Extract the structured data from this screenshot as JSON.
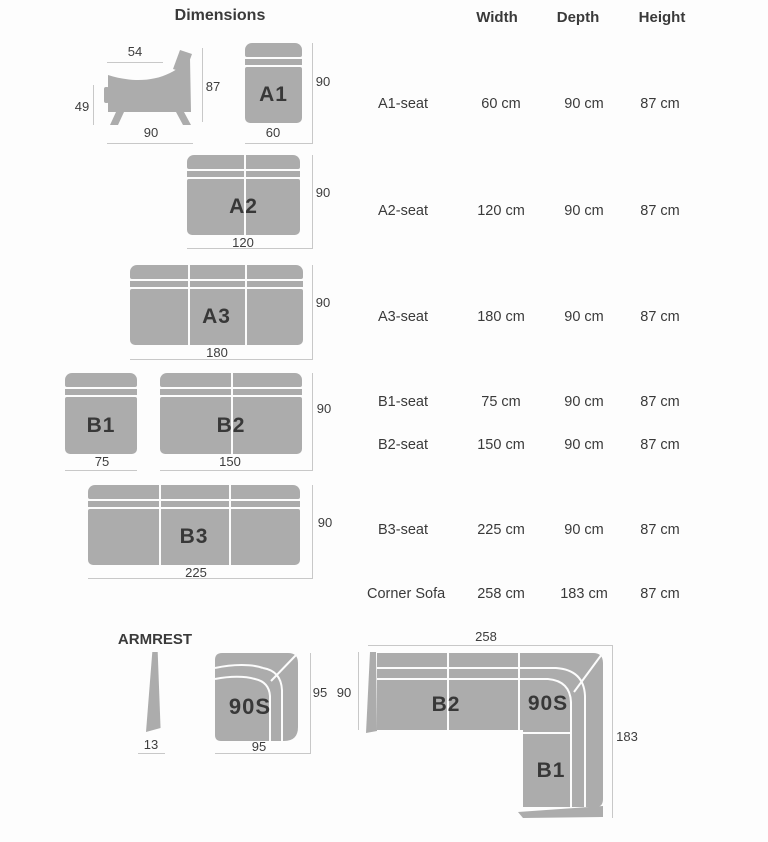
{
  "heading": "Dimensions",
  "table": {
    "headers": {
      "width": "Width",
      "depth": "Depth",
      "height": "Height"
    },
    "rows": [
      {
        "label": "A1-seat",
        "width": "60 cm",
        "depth": "90 cm",
        "height": "87 cm"
      },
      {
        "label": "A2-seat",
        "width": "120 cm",
        "depth": "90 cm",
        "height": "87 cm"
      },
      {
        "label": "A3-seat",
        "width": "180 cm",
        "depth": "90 cm",
        "height": "87 cm"
      },
      {
        "label": "B1-seat",
        "width": "75 cm",
        "depth": "90 cm",
        "height": "87 cm"
      },
      {
        "label": "B2-seat",
        "width": "150 cm",
        "depth": "90 cm",
        "height": "87 cm"
      },
      {
        "label": "B3-seat",
        "width": "225 cm",
        "depth": "90 cm",
        "height": "87 cm"
      },
      {
        "label": "Corner Sofa",
        "width": "258 cm",
        "depth": "183 cm",
        "height": "87 cm"
      }
    ]
  },
  "side_view": {
    "top_width": "54",
    "seat_height": "49",
    "total_height": "87",
    "total_depth": "90"
  },
  "modules": {
    "a1": {
      "label": "A1",
      "depth": "90",
      "width": "60"
    },
    "a2": {
      "label": "A2",
      "depth": "90",
      "width": "120"
    },
    "a3": {
      "label": "A3",
      "depth": "90",
      "width": "180"
    },
    "b1": {
      "label": "B1",
      "width": "75"
    },
    "b2": {
      "label": "B2",
      "depth": "90",
      "width": "150"
    },
    "b3": {
      "label": "B3",
      "depth": "90",
      "width": "225"
    }
  },
  "armrest": {
    "title": "ARMREST",
    "width": "13"
  },
  "s90": {
    "label": "90S",
    "depth": "95",
    "width": "95"
  },
  "corner": {
    "width": "258",
    "depth_left": "90",
    "depth_right": "183",
    "b2_label": "B2",
    "s90_label": "90S",
    "b1_label": "B1"
  }
}
